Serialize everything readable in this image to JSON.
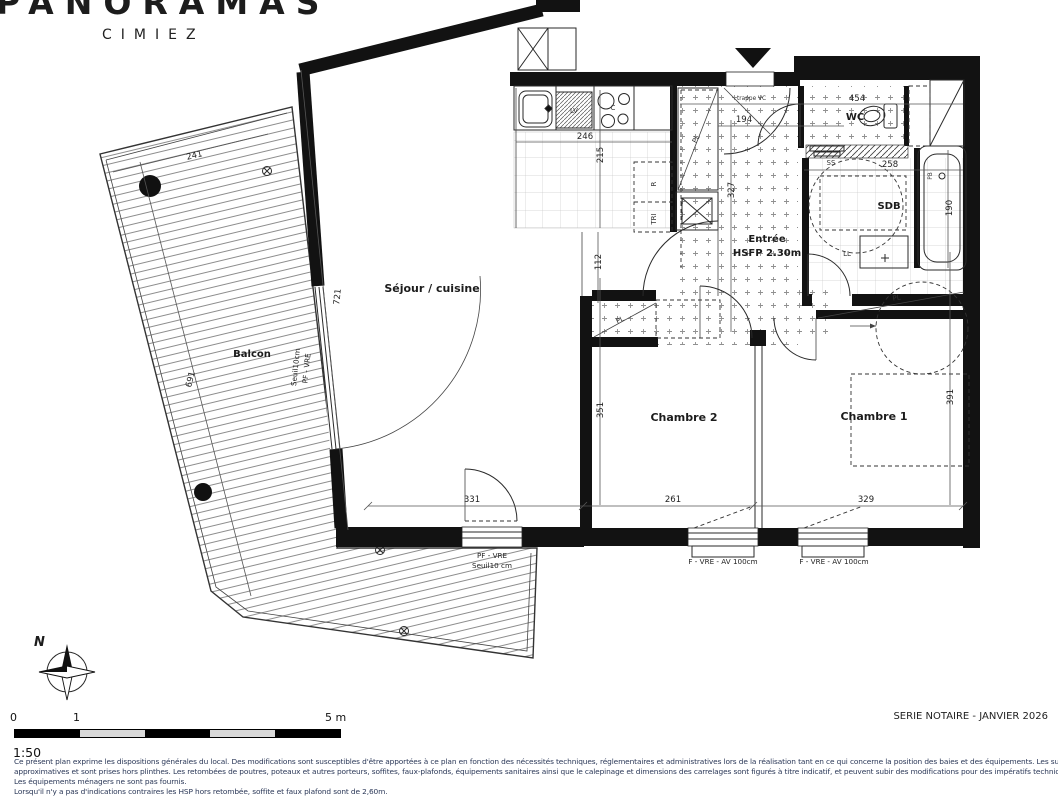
{
  "logo": {
    "brand": "PANORAMAS",
    "sub": "CIMIEZ"
  },
  "plan": {
    "rooms": {
      "balcon": "Balcon",
      "sejour": "Séjour / cuisine",
      "entree": "Entrée",
      "entree_note": "HSFP 2.30m",
      "wc": "WC",
      "sdb": "SDB",
      "chambre1": "Chambre 1",
      "chambre2": "Chambre 2"
    },
    "fixtures": {
      "lv": "LV",
      "hob": "C",
      "fridge": "R",
      "tri": "TRI",
      "closet": "PL",
      "towel_rail": "SS",
      "washer": "LL",
      "bath": "PB",
      "hatch": "trappe VC"
    },
    "dims": {
      "d241": "241",
      "d721": "721",
      "d691": "691",
      "d246": "246",
      "d215": "215",
      "d112": "112",
      "d194": "194",
      "d454": "454",
      "d258": "258",
      "d190": "190",
      "d327": "327",
      "d351": "351",
      "d391": "391",
      "d331": "331",
      "d261": "261",
      "d329": "329"
    },
    "openings": {
      "sejour_win_l1": "PF - VRE",
      "sejour_win_l2": "Seuil10 cm",
      "balcony_win_l1": "Seuil10cm",
      "balcony_win_l2": "PF - VRE",
      "win_ch2": "F - VRE - AV 100cm",
      "win_ch1": "F - VRE - AV 100cm"
    },
    "compass": "N"
  },
  "scalebar": {
    "t0": "0",
    "t1": "1",
    "t5": "5 m",
    "ratio": "1:50"
  },
  "footer": {
    "series": "SERIE NOTAIRE - JANVIER 2026",
    "legal1": "Ce présent plan exprime les dispositions générales du local. Des modifications sont susceptibles d'être apportées à ce plan en fonction des nécessités techniques, réglementaires et administratives lors de la réalisation tant en ce qui concerne la position des baies et des équipements. Les surfaces sont",
    "legal2": "approximatives et sont prises hors plinthes. Les retombées de poutres, poteaux et autres porteurs, soffites, faux-plafonds, équipements sanitaires ainsi que le calepinage et dimensions des carrelages sont figurés à titre indicatif, et peuvent subir des modifications pour des impératifs techniques.",
    "legal3": "Les équipements ménagers ne sont pas fournis.",
    "legal4": "Lorsqu'il n'y a pas d'indications contraires les HSP hors retombée, soffite et faux plafond sont de 2,60m."
  }
}
